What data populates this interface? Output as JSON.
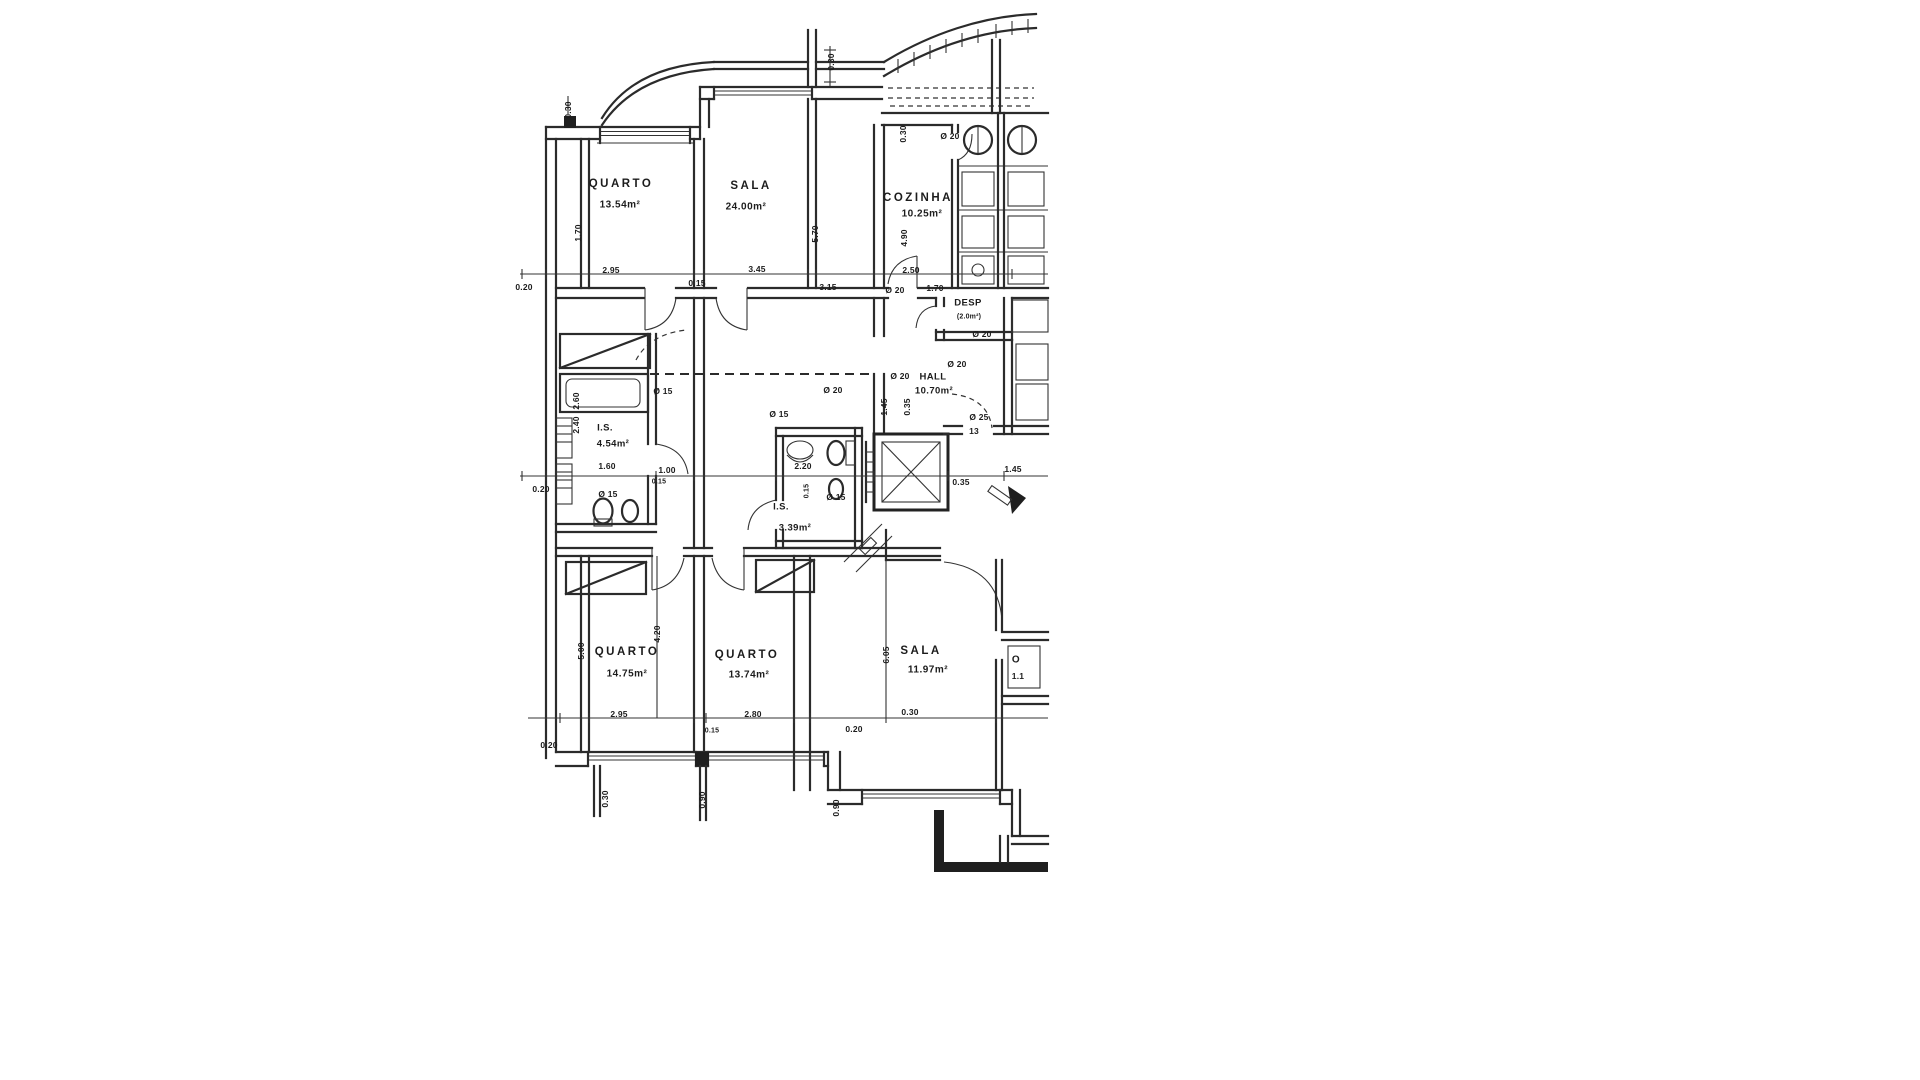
{
  "plan": {
    "language": "pt",
    "ink_color": "#2b2b2b",
    "paper_color": "#ffffff",
    "rooms": [
      {
        "name": "QUARTO",
        "area": "13.54m²"
      },
      {
        "name": "SALA",
        "area": "24.00m²"
      },
      {
        "name": "COZINHA",
        "area": "10.25m²"
      },
      {
        "name": "DESP",
        "area": "(2.0m²)"
      },
      {
        "name": "HALL",
        "area": "10.70m²"
      },
      {
        "name": "I.S.",
        "area": "4.54m²"
      },
      {
        "name": "I.S.",
        "area": "3.39m²"
      },
      {
        "name": "QUARTO",
        "area": "14.75m²"
      },
      {
        "name": "QUARTO",
        "area": "13.74m²"
      },
      {
        "name": "SALA",
        "area": "11.97m²"
      }
    ]
  },
  "labels": [
    {
      "t": "QUARTO",
      "x": 621,
      "y": 184,
      "c": "room",
      "n": "room-label-quarto-1"
    },
    {
      "t": "13.54m²",
      "x": 620,
      "y": 205,
      "c": "area",
      "n": "area-label-quarto-1"
    },
    {
      "t": "SALA",
      "x": 751,
      "y": 186,
      "c": "room",
      "n": "room-label-sala-1"
    },
    {
      "t": "24.00m²",
      "x": 746,
      "y": 207,
      "c": "area",
      "n": "area-label-sala-1"
    },
    {
      "t": "COZINHA",
      "x": 918,
      "y": 198,
      "c": "room",
      "n": "room-label-cozinha"
    },
    {
      "t": "10.25m²",
      "x": 922,
      "y": 214,
      "c": "area",
      "n": "area-label-cozinha"
    },
    {
      "t": "DESP",
      "x": 968,
      "y": 303,
      "c": "small",
      "n": "room-label-desp"
    },
    {
      "t": "(2.0m²)",
      "x": 969,
      "y": 317,
      "c": "tiny",
      "n": "area-label-desp"
    },
    {
      "t": "Ø 20",
      "x": 900,
      "y": 376,
      "c": "dim",
      "n": "dim-label"
    },
    {
      "t": "HALL",
      "x": 933,
      "y": 377,
      "c": "small",
      "n": "room-label-hall"
    },
    {
      "t": "10.70m²",
      "x": 934,
      "y": 391,
      "c": "small",
      "n": "area-label-hall"
    },
    {
      "t": "I.S.",
      "x": 605,
      "y": 428,
      "c": "small",
      "n": "room-label-is-1"
    },
    {
      "t": "4.54m²",
      "x": 613,
      "y": 444,
      "c": "small",
      "n": "area-label-is-1"
    },
    {
      "t": "I.S.",
      "x": 781,
      "y": 507,
      "c": "small",
      "n": "room-label-is-2"
    },
    {
      "t": "3.39m²",
      "x": 795,
      "y": 528,
      "c": "small",
      "n": "area-label-is-2"
    },
    {
      "t": "QUARTO",
      "x": 627,
      "y": 652,
      "c": "room",
      "n": "room-label-quarto-2"
    },
    {
      "t": "14.75m²",
      "x": 627,
      "y": 674,
      "c": "area",
      "n": "area-label-quarto-2"
    },
    {
      "t": "QUARTO",
      "x": 747,
      "y": 655,
      "c": "room",
      "n": "room-label-quarto-3"
    },
    {
      "t": "13.74m²",
      "x": 749,
      "y": 675,
      "c": "area",
      "n": "area-label-quarto-3"
    },
    {
      "t": "SALA",
      "x": 921,
      "y": 651,
      "c": "room",
      "n": "room-label-sala-2"
    },
    {
      "t": "11.97m²",
      "x": 928,
      "y": 670,
      "c": "area",
      "n": "area-label-sala-2"
    },
    {
      "t": "O",
      "x": 1016,
      "y": 660,
      "c": "area",
      "n": "room-label-cut"
    },
    {
      "t": "1.1",
      "x": 1018,
      "y": 676,
      "c": "dim",
      "n": "dim-label"
    },
    {
      "t": "0.30",
      "x": 568,
      "y": 110,
      "r": 1,
      "c": "dim",
      "n": "dim-label"
    },
    {
      "t": "0.30",
      "x": 831,
      "y": 62,
      "r": 1,
      "c": "dim",
      "n": "dim-label"
    },
    {
      "t": "1.70",
      "x": 578,
      "y": 233,
      "r": 1,
      "c": "dim",
      "n": "dim-label"
    },
    {
      "t": "5.70",
      "x": 815,
      "y": 234,
      "r": 1,
      "c": "dim",
      "n": "dim-label"
    },
    {
      "t": "4.90",
      "x": 904,
      "y": 238,
      "r": 1,
      "c": "dim",
      "n": "dim-label"
    },
    {
      "t": "0.30",
      "x": 903,
      "y": 134,
      "r": 1,
      "c": "dim",
      "n": "dim-label"
    },
    {
      "t": "Ø 20",
      "x": 950,
      "y": 136,
      "c": "dim",
      "n": "dim-label"
    },
    {
      "t": "0.20",
      "x": 524,
      "y": 287,
      "c": "dim",
      "n": "dim-label"
    },
    {
      "t": "2.95",
      "x": 611,
      "y": 270,
      "c": "dim",
      "n": "dim-label"
    },
    {
      "t": "0.15",
      "x": 697,
      "y": 283,
      "c": "dim",
      "n": "dim-label"
    },
    {
      "t": "3.45",
      "x": 757,
      "y": 269,
      "c": "dim",
      "n": "dim-label"
    },
    {
      "t": "3.15",
      "x": 828,
      "y": 287,
      "c": "dim",
      "n": "dim-label"
    },
    {
      "t": "2.50",
      "x": 911,
      "y": 270,
      "c": "dim",
      "n": "dim-label"
    },
    {
      "t": "Ø 20",
      "x": 895,
      "y": 290,
      "c": "dim",
      "n": "dim-label"
    },
    {
      "t": "1.70",
      "x": 935,
      "y": 288,
      "c": "dim",
      "n": "dim-label"
    },
    {
      "t": "0.20",
      "x": 541,
      "y": 489,
      "c": "dim",
      "n": "dim-label"
    },
    {
      "t": "2.60",
      "x": 576,
      "y": 401,
      "r": 1,
      "c": "dim",
      "n": "dim-label"
    },
    {
      "t": "2.40",
      "x": 576,
      "y": 425,
      "r": 1,
      "c": "dim",
      "n": "dim-label"
    },
    {
      "t": "1.60",
      "x": 607,
      "y": 466,
      "c": "dim",
      "n": "dim-label"
    },
    {
      "t": "1.00",
      "x": 667,
      "y": 470,
      "c": "dim",
      "n": "dim-label"
    },
    {
      "t": "0.15",
      "x": 659,
      "y": 482,
      "c": "tiny",
      "n": "dim-label"
    },
    {
      "t": "Ø 15",
      "x": 663,
      "y": 391,
      "c": "dim",
      "n": "dim-label"
    },
    {
      "t": "Ø 15",
      "x": 608,
      "y": 494,
      "c": "dim",
      "n": "dim-label"
    },
    {
      "t": "Ø 15",
      "x": 779,
      "y": 414,
      "c": "dim",
      "n": "dim-label"
    },
    {
      "t": "Ø 15",
      "x": 836,
      "y": 497,
      "c": "dim",
      "n": "dim-label"
    },
    {
      "t": "0.15",
      "x": 807,
      "y": 491,
      "r": 1,
      "c": "tiny",
      "n": "dim-label"
    },
    {
      "t": "2.20",
      "x": 803,
      "y": 466,
      "c": "dim",
      "n": "dim-label"
    },
    {
      "t": "Ø 20",
      "x": 833,
      "y": 390,
      "c": "dim",
      "n": "dim-label"
    },
    {
      "t": "Ø 20",
      "x": 957,
      "y": 364,
      "c": "dim",
      "n": "dim-label"
    },
    {
      "t": "Ø 20",
      "x": 982,
      "y": 334,
      "c": "dim",
      "n": "dim-label"
    },
    {
      "t": "Ø 25",
      "x": 979,
      "y": 417,
      "c": "dim",
      "n": "dim-label"
    },
    {
      "t": "13",
      "x": 974,
      "y": 431,
      "c": "dim",
      "n": "dim-label"
    },
    {
      "t": "1.45",
      "x": 884,
      "y": 407,
      "r": 1,
      "c": "dim",
      "n": "dim-label"
    },
    {
      "t": "0.35",
      "x": 907,
      "y": 407,
      "r": 1,
      "c": "dim",
      "n": "dim-label"
    },
    {
      "t": "1.45",
      "x": 1013,
      "y": 469,
      "c": "dim",
      "n": "dim-label"
    },
    {
      "t": "0.35",
      "x": 961,
      "y": 482,
      "c": "dim",
      "n": "dim-label"
    },
    {
      "t": "5.00",
      "x": 581,
      "y": 651,
      "r": 1,
      "c": "dim",
      "n": "dim-label"
    },
    {
      "t": "4.20",
      "x": 657,
      "y": 634,
      "r": 1,
      "c": "dim",
      "n": "dim-label"
    },
    {
      "t": "6.05",
      "x": 886,
      "y": 655,
      "r": 1,
      "c": "dim",
      "n": "dim-label"
    },
    {
      "t": "2.95",
      "x": 619,
      "y": 714,
      "c": "dim",
      "n": "dim-label"
    },
    {
      "t": "0.15",
      "x": 712,
      "y": 731,
      "c": "tiny",
      "n": "dim-label"
    },
    {
      "t": "2.80",
      "x": 753,
      "y": 714,
      "c": "dim",
      "n": "dim-label"
    },
    {
      "t": "0.30",
      "x": 910,
      "y": 712,
      "c": "dim",
      "n": "dim-label"
    },
    {
      "t": "0.20",
      "x": 854,
      "y": 729,
      "c": "dim",
      "n": "dim-label"
    },
    {
      "t": "0.20",
      "x": 549,
      "y": 745,
      "c": "dim",
      "n": "dim-label"
    },
    {
      "t": "0.30",
      "x": 605,
      "y": 799,
      "r": 1,
      "c": "dim",
      "n": "dim-label"
    },
    {
      "t": "0.90",
      "x": 702,
      "y": 800,
      "r": 1,
      "c": "dim",
      "n": "dim-label"
    },
    {
      "t": "0.90",
      "x": 836,
      "y": 808,
      "r": 1,
      "c": "dim",
      "n": "dim-label"
    }
  ]
}
